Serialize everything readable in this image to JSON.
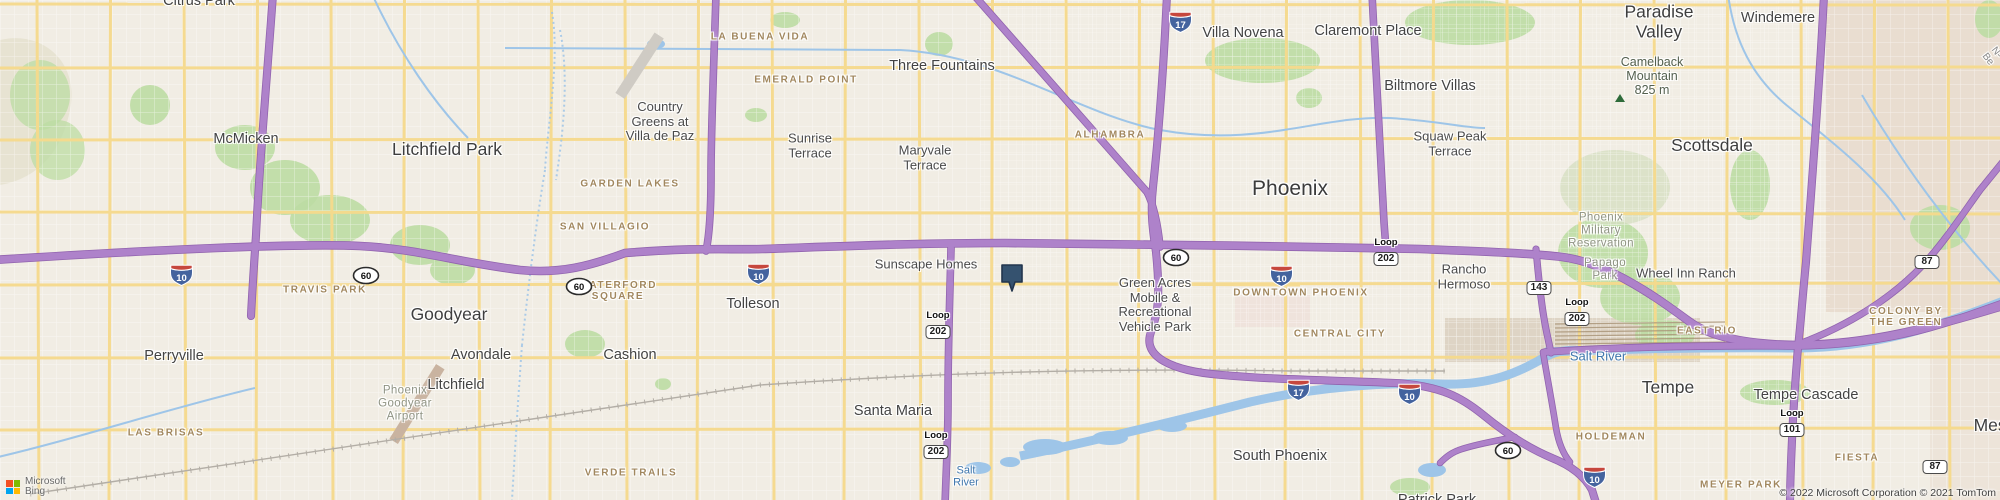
{
  "map": {
    "colors": {
      "land": "#f1ede4",
      "land_reservation": "#e9ddd0",
      "park_green": "#bcdca3",
      "water_blue": "#9ec5e8",
      "highway_purple": "#ae82ca",
      "highway_casing": "#9163ae",
      "arterial_yellow": "#f6da8c",
      "marker_fill": "#35526f",
      "marker_border": "#22354d",
      "hood_label": "#a1875e",
      "water_label": "#3f77ad"
    },
    "marker": {
      "x": 1000,
      "y": 263
    },
    "labels": [
      {
        "id": "citrus-park",
        "text": "Citrus Park",
        "type": "city",
        "x": 199,
        "y": 1
      },
      {
        "id": "mcmicken",
        "text": "McMicken",
        "type": "city",
        "x": 246,
        "y": 139
      },
      {
        "id": "litchfield-park",
        "text": "Litchfield Park",
        "type": "city-lg",
        "x": 447,
        "y": 150
      },
      {
        "id": "goodyear",
        "text": "Goodyear",
        "type": "city-lg",
        "x": 449,
        "y": 315
      },
      {
        "id": "avondale",
        "text": "Avondale",
        "type": "city",
        "x": 481,
        "y": 355
      },
      {
        "id": "perryville",
        "text": "Perryville",
        "type": "city",
        "x": 174,
        "y": 356
      },
      {
        "id": "cashion",
        "text": "Cashion",
        "type": "city",
        "x": 630,
        "y": 355
      },
      {
        "id": "litchfield",
        "text": "Litchfield",
        "type": "city",
        "x": 456,
        "y": 385
      },
      {
        "id": "tolleson",
        "text": "Tolleson",
        "type": "city",
        "x": 753,
        "y": 304
      },
      {
        "id": "santa-maria",
        "text": "Santa Maria",
        "type": "city",
        "x": 893,
        "y": 411
      },
      {
        "id": "phoenix",
        "text": "Phoenix",
        "type": "city-xl",
        "x": 1290,
        "y": 189
      },
      {
        "id": "scottsdale",
        "text": "Scottsdale",
        "type": "city-lg",
        "x": 1712,
        "y": 146
      },
      {
        "id": "tempe",
        "text": "Tempe",
        "type": "city-lg",
        "x": 1668,
        "y": 388
      },
      {
        "id": "mesa",
        "text": "Mesa",
        "type": "city-lg",
        "x": 1995,
        "y": 426
      },
      {
        "id": "paradise-valley",
        "text": "Paradise\nValley",
        "type": "city-lg",
        "x": 1659,
        "y": 22
      },
      {
        "id": "windemere",
        "text": "Windemere",
        "type": "city",
        "x": 1778,
        "y": 18
      },
      {
        "id": "villa-novena",
        "text": "Villa Novena",
        "type": "city",
        "x": 1243,
        "y": 33
      },
      {
        "id": "claremont-place",
        "text": "Claremont Place",
        "type": "city",
        "x": 1368,
        "y": 31
      },
      {
        "id": "three-fountains",
        "text": "Three Fountains",
        "type": "city",
        "x": 942,
        "y": 66
      },
      {
        "id": "biltmore-villas",
        "text": "Biltmore Villas",
        "type": "city",
        "x": 1430,
        "y": 86
      },
      {
        "id": "south-phoenix",
        "text": "South Phoenix",
        "type": "city",
        "x": 1280,
        "y": 456
      },
      {
        "id": "patrick-park",
        "text": "Patrick Park",
        "type": "city",
        "x": 1437,
        "y": 500
      },
      {
        "id": "tempe-cascade",
        "text": "Tempe Cascade",
        "type": "city",
        "x": 1806,
        "y": 395
      },
      {
        "id": "squaw-peak-terrace",
        "text": "Squaw Peak\nTerrace",
        "type": "town",
        "x": 1450,
        "y": 144
      },
      {
        "id": "sunrise-terrace",
        "text": "Sunrise\nTerrace",
        "type": "town",
        "x": 810,
        "y": 146
      },
      {
        "id": "maryvale-terrace",
        "text": "Maryvale\nTerrace",
        "type": "town",
        "x": 925,
        "y": 158
      },
      {
        "id": "country-greens",
        "text": "Country\nGreens at\nVilla de Paz",
        "type": "town",
        "x": 660,
        "y": 122
      },
      {
        "id": "sunscape-homes",
        "text": "Sunscape Homes",
        "type": "town",
        "x": 926,
        "y": 265
      },
      {
        "id": "green-acres",
        "text": "Green Acres\nMobile &\nRecreational\nVehicle Park",
        "type": "town",
        "x": 1155,
        "y": 305
      },
      {
        "id": "rancho-hermoso",
        "text": "Rancho\nHermoso",
        "type": "town",
        "x": 1464,
        "y": 277
      },
      {
        "id": "wheel-inn-ranch",
        "text": "Wheel Inn Ranch",
        "type": "town",
        "x": 1686,
        "y": 274
      },
      {
        "id": "la-buena-vida",
        "text": "LA BUENA VIDA",
        "type": "hood",
        "x": 760,
        "y": 37
      },
      {
        "id": "emerald-point",
        "text": "EMERALD POINT",
        "type": "hood",
        "x": 806,
        "y": 80
      },
      {
        "id": "garden-lakes",
        "text": "GARDEN LAKES",
        "type": "hood",
        "x": 630,
        "y": 184
      },
      {
        "id": "san-villagio",
        "text": "SAN VILLAGIO",
        "type": "hood",
        "x": 605,
        "y": 227
      },
      {
        "id": "alhambra",
        "text": "ALHAMBRA",
        "type": "hood",
        "x": 1110,
        "y": 135
      },
      {
        "id": "waterford-square",
        "text": "WATERFORD\nSQUARE",
        "type": "hood",
        "x": 618,
        "y": 291
      },
      {
        "id": "travis-park",
        "text": "TRAVIS PARK",
        "type": "hood",
        "x": 325,
        "y": 290
      },
      {
        "id": "downtown-phoenix",
        "text": "DOWNTOWN PHOENIX",
        "type": "hood",
        "x": 1301,
        "y": 293
      },
      {
        "id": "central-city",
        "text": "CENTRAL CITY",
        "type": "hood",
        "x": 1340,
        "y": 334
      },
      {
        "id": "las-brisas",
        "text": "LAS BRISAS",
        "type": "hood",
        "x": 166,
        "y": 433
      },
      {
        "id": "verde-trails",
        "text": "VERDE TRAILS",
        "type": "hood",
        "x": 631,
        "y": 473
      },
      {
        "id": "east-rio",
        "text": "EAST RIO",
        "type": "hood",
        "x": 1707,
        "y": 331
      },
      {
        "id": "colony-by-the-green",
        "text": "COLONY BY\nTHE GREEN",
        "type": "hood",
        "x": 1906,
        "y": 317
      },
      {
        "id": "holdeman",
        "text": "HOLDEMAN",
        "type": "hood",
        "x": 1611,
        "y": 437
      },
      {
        "id": "fiesta",
        "text": "FIESTA",
        "type": "hood",
        "x": 1857,
        "y": 458
      },
      {
        "id": "meyer-park",
        "text": "MEYER PARK",
        "type": "hood",
        "x": 1741,
        "y": 485
      },
      {
        "id": "phx-military-reservation",
        "text": "Phoenix\nMilitary\nReservation",
        "type": "area",
        "x": 1601,
        "y": 231
      },
      {
        "id": "papago-park",
        "text": "Papago\nPark",
        "type": "area",
        "x": 1605,
        "y": 270
      },
      {
        "id": "phx-goodyear-airport",
        "text": "Phoenix\nGoodyear\nAirport",
        "type": "area",
        "x": 405,
        "y": 404
      },
      {
        "id": "salt-river",
        "text": "Salt River",
        "type": "water",
        "x": 1598,
        "y": 357
      },
      {
        "id": "salt-river-sm",
        "text": "Salt\nRiver",
        "type": "water-sm",
        "x": 966,
        "y": 477
      },
      {
        "id": "camelback-mountain",
        "text": "Camelback\nMountain\n825 m",
        "type": "peak",
        "x": 1652,
        "y": 76
      },
      {
        "id": "n-be-road",
        "text": "N-Be",
        "type": "road-rot",
        "x": 1992,
        "y": 56
      }
    ],
    "shields": [
      {
        "type": "interstate",
        "num": "17",
        "x": 1167,
        "y": 10
      },
      {
        "type": "interstate",
        "num": "10",
        "x": 168,
        "y": 263
      },
      {
        "type": "us",
        "num": "60",
        "x": 352,
        "y": 266
      },
      {
        "type": "us",
        "num": "60",
        "x": 565,
        "y": 277
      },
      {
        "type": "interstate",
        "num": "10",
        "x": 745,
        "y": 262
      },
      {
        "type": "us",
        "num": "60",
        "x": 1162,
        "y": 248
      },
      {
        "type": "interstate",
        "num": "10",
        "x": 1268,
        "y": 264
      },
      {
        "type": "loop",
        "prefix": "Loop",
        "num": "202",
        "x": 1386,
        "y": 252
      },
      {
        "type": "loop",
        "prefix": "Loop",
        "num": "202",
        "x": 938,
        "y": 325
      },
      {
        "type": "state",
        "num": "143",
        "x": 1539,
        "y": 286
      },
      {
        "type": "loop",
        "prefix": "Loop",
        "num": "202",
        "x": 1577,
        "y": 312
      },
      {
        "type": "state",
        "num": "87",
        "x": 1927,
        "y": 260
      },
      {
        "type": "loop",
        "prefix": "Loop",
        "num": "202",
        "x": 936,
        "y": 445
      },
      {
        "type": "interstate",
        "num": "17",
        "x": 1285,
        "y": 378
      },
      {
        "type": "interstate",
        "num": "10",
        "x": 1396,
        "y": 382
      },
      {
        "type": "us",
        "num": "60",
        "x": 1494,
        "y": 441
      },
      {
        "type": "interstate",
        "num": "10",
        "x": 1581,
        "y": 465
      },
      {
        "type": "loop",
        "prefix": "Loop",
        "num": "101",
        "x": 1792,
        "y": 423
      },
      {
        "type": "state",
        "num": "87",
        "x": 1935,
        "y": 465
      }
    ],
    "peak_icon": {
      "x": 1620,
      "y": 98
    }
  },
  "attribution": {
    "logo_line1": "Microsoft",
    "logo_line2": "Bing",
    "copyright": "© 2022 Microsoft Corporation © 2021 TomTom"
  }
}
